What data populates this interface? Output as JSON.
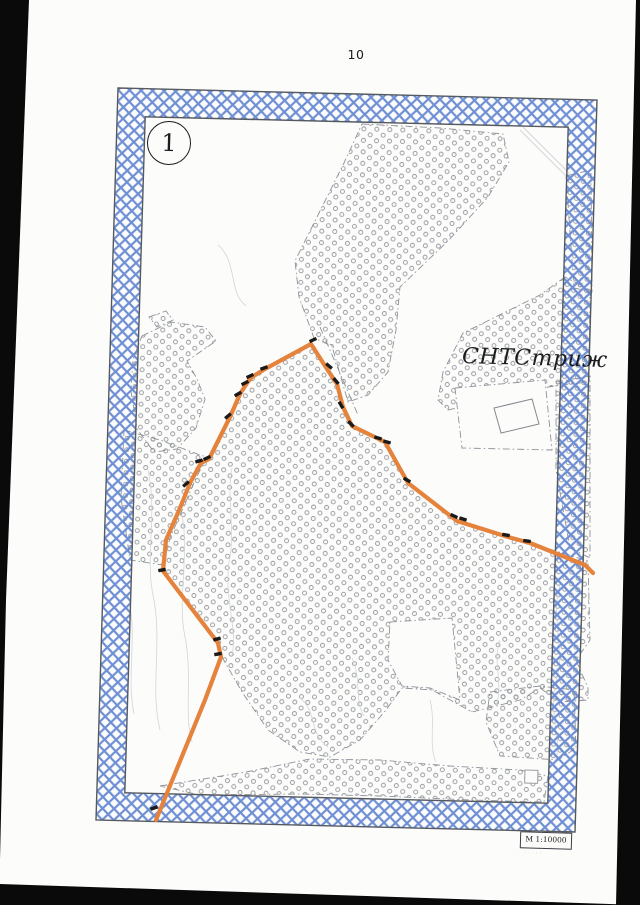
{
  "page": {
    "number": "10"
  },
  "sheet": {
    "number_label": "1",
    "circle_center": [
      168,
      142
    ],
    "circle_r": 21
  },
  "frame": {
    "outer": [
      [
        118,
        88
      ],
      [
        597,
        100
      ],
      [
        575,
        832
      ],
      [
        96,
        820
      ]
    ],
    "inner": [
      [
        145.2,
        116.8
      ],
      [
        568.2,
        127.2
      ],
      [
        547.8,
        803.2
      ],
      [
        124.8,
        792.8
      ]
    ],
    "lattice_color": "#6689d2",
    "lattice_spacing": 11.5,
    "edge_color": "#555a61",
    "rotation_deg": 1.7
  },
  "map": {
    "region_label": "СНТСтриж",
    "scale_label": "М 1:10000",
    "colors": {
      "paper": "#fcfcfa",
      "route": "#e5823b",
      "marker": "#1a1a1a",
      "stipple": "#94979e",
      "boundary": "#8d929b",
      "contour": "#cfd6dd",
      "artifact": "#d4d6da",
      "scan_black": "#0a0a0b"
    },
    "stipple_regions": [
      {
        "name": "north-woodland",
        "points": [
          [
            362,
            124
          ],
          [
            440,
            128
          ],
          [
            503,
            134
          ],
          [
            509,
            162
          ],
          [
            488,
            197
          ],
          [
            448,
            241
          ],
          [
            400,
            287
          ],
          [
            396,
            330
          ],
          [
            388,
            372
          ],
          [
            368,
            395
          ],
          [
            348,
            402
          ],
          [
            332,
            346
          ],
          [
            314,
            338
          ],
          [
            299,
            297
          ],
          [
            295,
            261
          ],
          [
            320,
            211
          ],
          [
            344,
            163
          ]
        ]
      },
      {
        "name": "northeast-corner-sliver",
        "points": [
          [
            566,
            176
          ],
          [
            591,
            170
          ],
          [
            592,
            292
          ],
          [
            574,
            288
          ]
        ]
      },
      {
        "name": "west-island",
        "points": [
          [
            142,
            336
          ],
          [
            171,
            322
          ],
          [
            205,
            327
          ],
          [
            216,
            341
          ],
          [
            200,
            352
          ],
          [
            187,
            361
          ],
          [
            197,
            379
          ],
          [
            205,
            399
          ],
          [
            196,
            428
          ],
          [
            177,
            449
          ],
          [
            154,
            452
          ],
          [
            137,
            429
          ],
          [
            131,
            391
          ],
          [
            133,
            359
          ]
        ]
      },
      {
        "name": "west-islet",
        "points": [
          [
            149,
            317
          ],
          [
            166,
            311
          ],
          [
            173,
            320
          ],
          [
            157,
            327
          ]
        ]
      },
      {
        "name": "central-woodland",
        "points": [
          [
            311,
            345
          ],
          [
            327,
            369
          ],
          [
            337,
            384
          ],
          [
            343,
            407
          ],
          [
            352,
            426
          ],
          [
            385,
            442
          ],
          [
            408,
            483
          ],
          [
            457,
            521
          ],
          [
            508,
            537
          ],
          [
            530,
            543
          ],
          [
            588,
            561
          ],
          [
            590,
            640
          ],
          [
            576,
            660
          ],
          [
            588,
            688
          ],
          [
            588,
            700
          ],
          [
            560,
            702
          ],
          [
            540,
            688
          ],
          [
            520,
            700
          ],
          [
            472,
            712
          ],
          [
            432,
            690
          ],
          [
            402,
            688
          ],
          [
            386,
            710
          ],
          [
            360,
            740
          ],
          [
            330,
            757
          ],
          [
            300,
            752
          ],
          [
            268,
            730
          ],
          [
            242,
            692
          ],
          [
            222,
            657
          ],
          [
            218,
            643
          ],
          [
            163,
            572
          ],
          [
            166,
            540
          ],
          [
            180,
            508
          ],
          [
            190,
            483
          ],
          [
            201,
            463
          ],
          [
            209,
            459
          ],
          [
            230,
            417
          ],
          [
            240,
            394
          ],
          [
            247,
            383
          ],
          [
            252,
            377
          ],
          [
            265,
            369
          ],
          [
            290,
            355
          ]
        ]
      },
      {
        "name": "west-strip",
        "points": [
          [
            124,
            430
          ],
          [
            160,
            440
          ],
          [
            200,
            455
          ],
          [
            207,
            457
          ],
          [
            196,
            478
          ],
          [
            184,
            506
          ],
          [
            170,
            538
          ],
          [
            163,
            565
          ],
          [
            130,
            560
          ],
          [
            121,
            498
          ]
        ]
      },
      {
        "name": "east-label-area",
        "points": [
          [
            565,
            277
          ],
          [
            540,
            295
          ],
          [
            463,
            333
          ],
          [
            443,
            372
          ],
          [
            438,
            400
          ],
          [
            448,
            410
          ],
          [
            470,
            405
          ],
          [
            532,
            390
          ],
          [
            560,
            385
          ],
          [
            589,
            382
          ],
          [
            590,
            290
          ]
        ]
      },
      {
        "name": "east-border-sliver",
        "points": [
          [
            556,
            382
          ],
          [
            590,
            376
          ],
          [
            590,
            558
          ],
          [
            570,
            548
          ],
          [
            556,
            470
          ]
        ]
      },
      {
        "name": "south-strip",
        "points": [
          [
            160,
            786
          ],
          [
            246,
            772
          ],
          [
            310,
            759
          ],
          [
            380,
            760
          ],
          [
            450,
            766
          ],
          [
            520,
            770
          ],
          [
            548,
            776
          ],
          [
            544,
            802
          ],
          [
            470,
            800
          ],
          [
            380,
            796
          ],
          [
            300,
            794
          ],
          [
            200,
            795
          ]
        ]
      },
      {
        "name": "southeast-patch",
        "points": [
          [
            490,
            692
          ],
          [
            540,
            686
          ],
          [
            574,
            690
          ],
          [
            576,
            748
          ],
          [
            558,
            760
          ],
          [
            500,
            756
          ],
          [
            486,
            722
          ]
        ]
      }
    ],
    "white_patches": [
      {
        "name": "building-pocket",
        "points": [
          [
            455,
            388
          ],
          [
            545,
            380
          ],
          [
            552,
            450
          ],
          [
            462,
            448
          ]
        ]
      },
      {
        "name": "south-bay",
        "points": [
          [
            390,
            622
          ],
          [
            452,
            618
          ],
          [
            460,
            700
          ],
          [
            430,
            688
          ],
          [
            402,
            686
          ],
          [
            388,
            660
          ]
        ]
      }
    ],
    "extra_boundaries": [
      "M320,327 L358,415"
    ],
    "artifact_lines": [
      "M520,130 L567,177",
      "M523,127 L570,174"
    ],
    "contours": [
      "M148,470 C158,515 144,558 154,600 C162,645 150,690 160,730",
      "M182,515 C190,558 176,600 186,642 C192,682 184,715 192,742",
      "M128,595 C138,636 126,676 134,714",
      "M232,468 C226,500 236,532 229,562 C224,600 238,630 232,655",
      "M560,585 C550,618 566,650 556,682 C548,715 562,738 556,760",
      "M300,698 C318,712 308,733 328,747",
      "M352,658 C362,680 354,700 364,716",
      "M430,700 C436,722 428,744 436,762",
      "M218,245 C238,262 228,292 246,306",
      "M500,640 C492,662 504,684 496,706"
    ],
    "route": {
      "width": 4.2,
      "points": [
        [
          156,
          820
        ],
        [
          205,
          700
        ],
        [
          221,
          657
        ],
        [
          218,
          643
        ],
        [
          163,
          571
        ],
        [
          166,
          540
        ],
        [
          180,
          508
        ],
        [
          190,
          483
        ],
        [
          201,
          463
        ],
        [
          209,
          459
        ],
        [
          230,
          417
        ],
        [
          240,
          394
        ],
        [
          247,
          383
        ],
        [
          252,
          377
        ],
        [
          265,
          369
        ],
        [
          311,
          344
        ],
        [
          327,
          369
        ],
        [
          337,
          384
        ],
        [
          343,
          407
        ],
        [
          352,
          426
        ],
        [
          385,
          442
        ],
        [
          408,
          483
        ],
        [
          457,
          521
        ],
        [
          508,
          537
        ],
        [
          530,
          543
        ],
        [
          585,
          565
        ],
        [
          593,
          573
        ]
      ],
      "markers": [
        [
          313,
          340,
          -25
        ],
        [
          264,
          368,
          -20
        ],
        [
          250,
          376,
          -25
        ],
        [
          245,
          383,
          -28
        ],
        [
          238,
          394,
          -30
        ],
        [
          228,
          416,
          -40
        ],
        [
          207,
          458,
          -25
        ],
        [
          199,
          461,
          -15
        ],
        [
          186,
          484,
          -40
        ],
        [
          162,
          570,
          -10
        ],
        [
          217,
          639,
          -15
        ],
        [
          218,
          654,
          -10
        ],
        [
          154,
          808,
          -20
        ],
        [
          329,
          366,
          40
        ],
        [
          336,
          381,
          50
        ],
        [
          341,
          405,
          60
        ],
        [
          351,
          424,
          45
        ],
        [
          378,
          438,
          15
        ],
        [
          387,
          442,
          15
        ],
        [
          407,
          480,
          30
        ],
        [
          454,
          516,
          25
        ],
        [
          463,
          519,
          18
        ],
        [
          506,
          535,
          10
        ],
        [
          527,
          541,
          8
        ]
      ]
    },
    "building": [
      [
        494,
        408
      ],
      [
        532,
        399
      ],
      [
        539,
        424
      ],
      [
        501,
        433
      ]
    ],
    "small_square": {
      "x": 525,
      "y": 770,
      "w": 13,
      "h": 13
    }
  },
  "scan_edges": {
    "left": [
      [
        0,
        0
      ],
      [
        29,
        0
      ],
      [
        6,
        600
      ],
      [
        0,
        860
      ]
    ],
    "right": [
      [
        636,
        0
      ],
      [
        640,
        0
      ],
      [
        640,
        905
      ],
      [
        616,
        905
      ]
    ],
    "bottom": [
      [
        0,
        884
      ],
      [
        640,
        905
      ],
      [
        0,
        905
      ]
    ]
  }
}
